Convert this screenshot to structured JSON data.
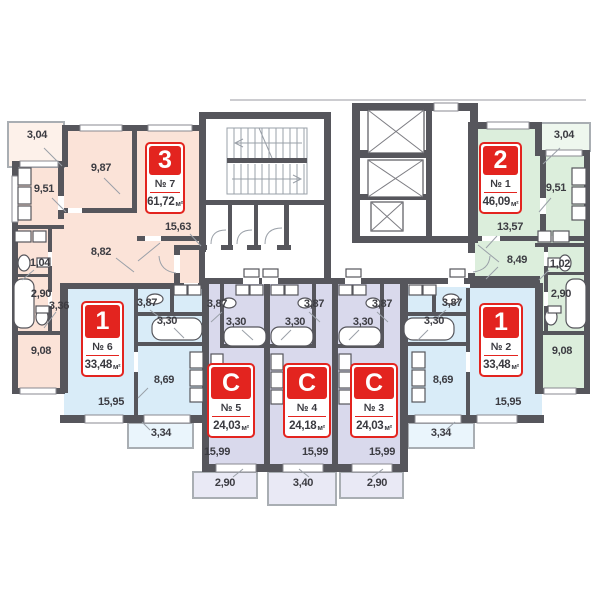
{
  "colors": {
    "wall": "#56565c",
    "peach": "#fbe3d8",
    "peach_light": "#fdf1ea",
    "green": "#dceedc",
    "green_light": "#eef7ee",
    "blue": "#d9ecf8",
    "blue_light": "#eaf5fc",
    "lavender": "#d9d9ec",
    "lavender_light": "#e9e9f5",
    "badge_red": "#e3241f",
    "dim_text": "#3c3c42"
  },
  "units": [
    {
      "id": "apt7",
      "badge": "3",
      "number": "№ 7",
      "area": "61,72",
      "area_unit": "м²"
    },
    {
      "id": "apt1",
      "badge": "2",
      "number": "№ 1",
      "area": "46,09",
      "area_unit": "м²"
    },
    {
      "id": "apt6",
      "badge": "1",
      "number": "№ 6",
      "area": "33,48",
      "area_unit": "м²"
    },
    {
      "id": "apt2",
      "badge": "1",
      "number": "№ 2",
      "area": "33,48",
      "area_unit": "м²"
    },
    {
      "id": "apt5",
      "badge": "С",
      "number": "№ 5",
      "area": "24,03",
      "area_unit": "м²"
    },
    {
      "id": "apt4",
      "badge": "С",
      "number": "№ 4",
      "area": "24,18",
      "area_unit": "м²"
    },
    {
      "id": "apt3",
      "badge": "С",
      "number": "№ 3",
      "area": "24,03",
      "area_unit": "м²"
    }
  ],
  "dims": {
    "apt7": {
      "balcony": "3,04",
      "kitchen": "9,51",
      "bedroom": "9,87",
      "living": "15,63",
      "hall": "8,82",
      "wc": "1,04",
      "bath": "2,90",
      "corridor": "3,36",
      "room2": "9,08"
    },
    "apt1": {
      "balcony": "3,04",
      "kitchen": "9,51",
      "living": "13,57",
      "hall": "8,49",
      "wc": "1,02",
      "bath": "2,90",
      "room2": "9,08"
    },
    "apt6": {
      "hall": "3,87",
      "bath": "3,30",
      "kitchen": "8,69",
      "living": "15,95",
      "balcony": "3,34"
    },
    "apt2": {
      "hall": "3,87",
      "bath": "3,30",
      "kitchen": "8,69",
      "living": "15,95",
      "balcony": "3,34"
    },
    "apt5": {
      "hall": "3,87",
      "bath": "3,30",
      "living": "15,99",
      "balcony": "2,90"
    },
    "apt4": {
      "hall": "3,87",
      "bath": "3,30",
      "living": "15,99",
      "balcony": "3,40"
    },
    "apt3": {
      "hall": "3,87",
      "bath": "3,30",
      "living": "15,99",
      "balcony": "2,90"
    }
  }
}
